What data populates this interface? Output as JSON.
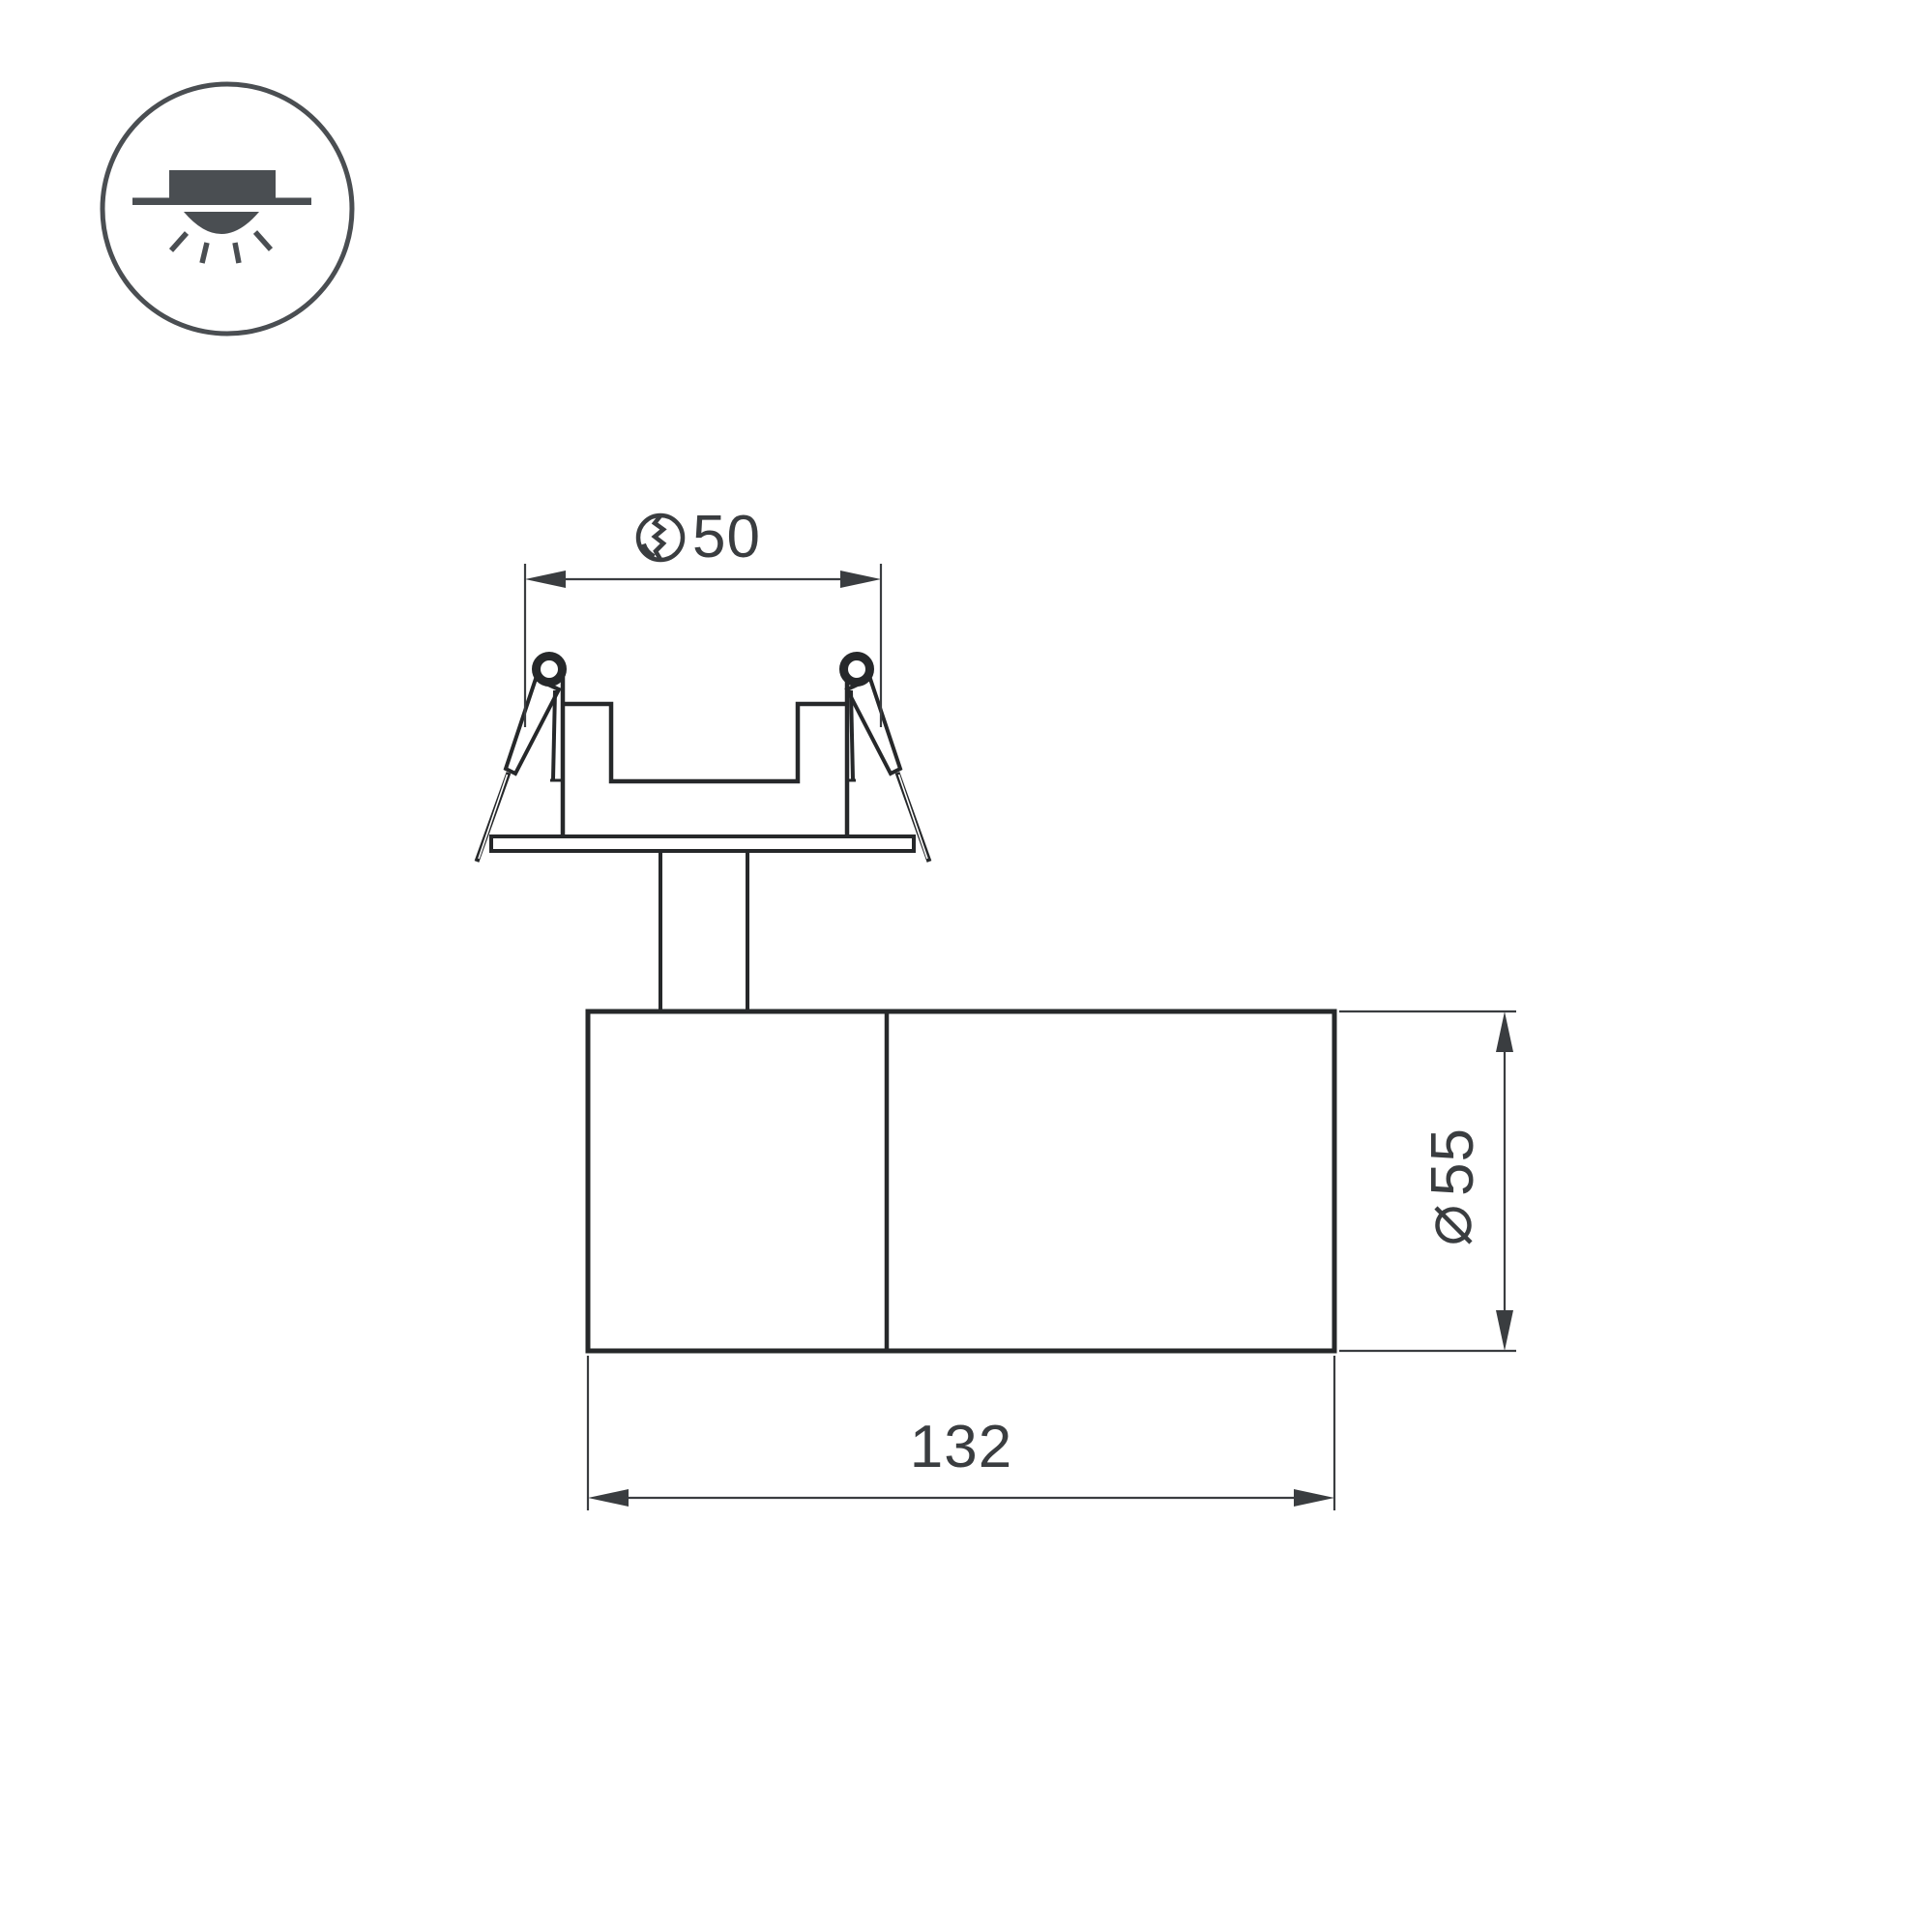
{
  "drawing": {
    "kind": "luminaire-technical-drawing",
    "mount_type_icon": "recessed-downlight",
    "dimensions": {
      "cutout": {
        "symbol": "hole-cut",
        "value": "50"
      },
      "diameter": {
        "symbol": "diameter",
        "value": "55"
      },
      "length": {
        "value": "132"
      }
    }
  },
  "colors": {
    "background": "#ffffff",
    "outline": "#26282a",
    "dimension": "#3a3d40",
    "icon": "#4a4e52"
  }
}
